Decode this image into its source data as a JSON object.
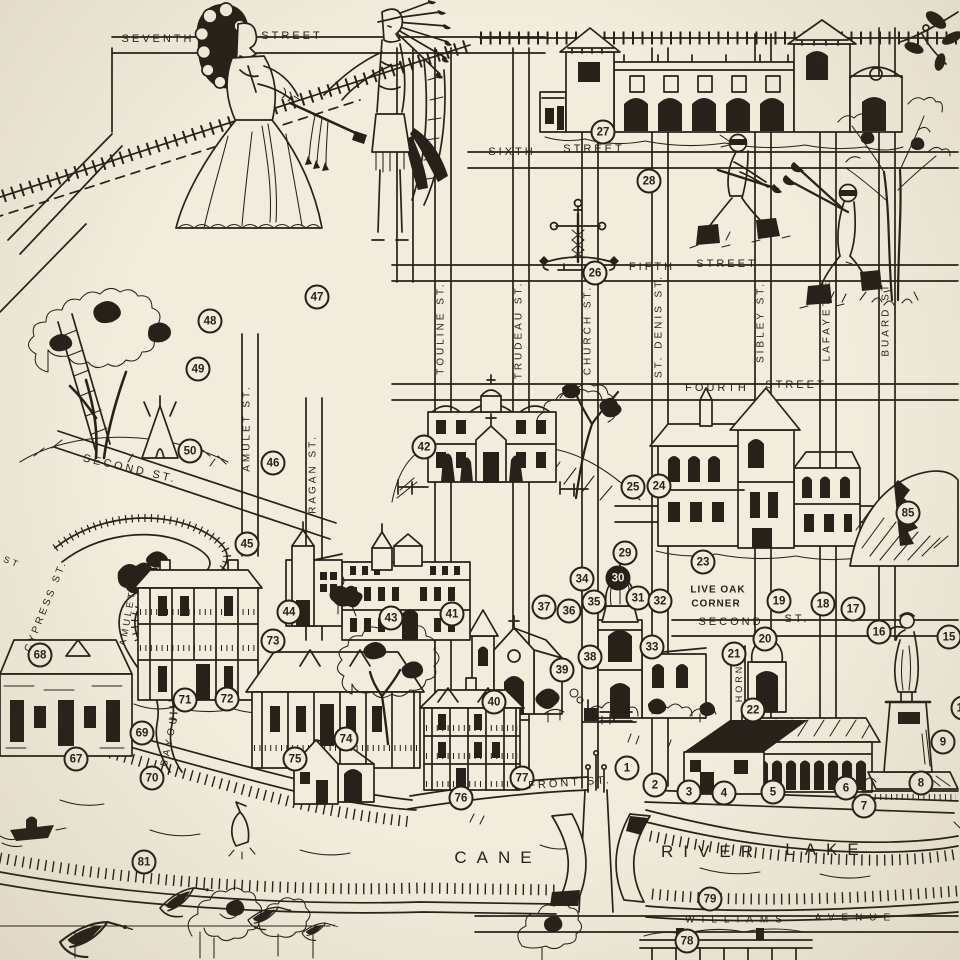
{
  "map": {
    "paper_color": "#f2ecdc",
    "ink_color": "#27211a",
    "illustrations": [
      "colonial-woman-figure",
      "indian-chief-figure",
      "peace-pipe",
      "railroad-tracks",
      "mission-revival-building",
      "raquette-players",
      "iron-cross-monument",
      "live-oak-tree",
      "ladder",
      "tepee",
      "convent-building",
      "courthouse-building",
      "rocky-hill",
      "cathedral",
      "gothic-chapel",
      "school-building",
      "small-church",
      "plantation-house",
      "stone-cottage",
      "raised-cottage",
      "victorian-house",
      "arcade-building",
      "warehouse-building",
      "st-denis-statue",
      "bridge",
      "riverfront-building",
      "motorboat",
      "jumping-fish",
      "flying-geese",
      "riverside-trees",
      "tall-tree",
      "magnolia-branch",
      "bayou-channel",
      "cane-river"
    ],
    "markers": [
      {
        "n": "1",
        "x": 627,
        "y": 768
      },
      {
        "n": "2",
        "x": 655,
        "y": 785
      },
      {
        "n": "3",
        "x": 689,
        "y": 792
      },
      {
        "n": "4",
        "x": 724,
        "y": 793
      },
      {
        "n": "5",
        "x": 773,
        "y": 792
      },
      {
        "n": "6",
        "x": 846,
        "y": 788
      },
      {
        "n": "7",
        "x": 864,
        "y": 806
      },
      {
        "n": "8",
        "x": 921,
        "y": 783
      },
      {
        "n": "9",
        "x": 943,
        "y": 742
      },
      {
        "n": "14",
        "x": 963,
        "y": 708
      },
      {
        "n": "15",
        "x": 949,
        "y": 637
      },
      {
        "n": "16",
        "x": 879,
        "y": 632
      },
      {
        "n": "17",
        "x": 853,
        "y": 609
      },
      {
        "n": "18",
        "x": 823,
        "y": 604
      },
      {
        "n": "19",
        "x": 779,
        "y": 601
      },
      {
        "n": "20",
        "x": 765,
        "y": 639
      },
      {
        "n": "21",
        "x": 734,
        "y": 654
      },
      {
        "n": "22",
        "x": 753,
        "y": 710
      },
      {
        "n": "23",
        "x": 703,
        "y": 562
      },
      {
        "n": "24",
        "x": 659,
        "y": 486
      },
      {
        "n": "25",
        "x": 633,
        "y": 487
      },
      {
        "n": "26",
        "x": 595,
        "y": 273
      },
      {
        "n": "27",
        "x": 603,
        "y": 132
      },
      {
        "n": "28",
        "x": 649,
        "y": 181
      },
      {
        "n": "29",
        "x": 625,
        "y": 553
      },
      {
        "n": "30",
        "x": 618,
        "y": 578,
        "filled": true
      },
      {
        "n": "31",
        "x": 638,
        "y": 598
      },
      {
        "n": "32",
        "x": 660,
        "y": 601
      },
      {
        "n": "33",
        "x": 652,
        "y": 647
      },
      {
        "n": "34",
        "x": 582,
        "y": 579
      },
      {
        "n": "35",
        "x": 594,
        "y": 602
      },
      {
        "n": "36",
        "x": 569,
        "y": 611
      },
      {
        "n": "37",
        "x": 544,
        "y": 607
      },
      {
        "n": "38",
        "x": 590,
        "y": 657
      },
      {
        "n": "39",
        "x": 562,
        "y": 670
      },
      {
        "n": "40",
        "x": 494,
        "y": 702
      },
      {
        "n": "41",
        "x": 452,
        "y": 614
      },
      {
        "n": "42",
        "x": 424,
        "y": 447
      },
      {
        "n": "43",
        "x": 391,
        "y": 618
      },
      {
        "n": "44",
        "x": 289,
        "y": 612
      },
      {
        "n": "45",
        "x": 247,
        "y": 544
      },
      {
        "n": "46",
        "x": 273,
        "y": 463
      },
      {
        "n": "47",
        "x": 317,
        "y": 297
      },
      {
        "n": "48",
        "x": 210,
        "y": 321
      },
      {
        "n": "49",
        "x": 198,
        "y": 369
      },
      {
        "n": "50",
        "x": 190,
        "y": 451
      },
      {
        "n": "67",
        "x": 76,
        "y": 759
      },
      {
        "n": "68",
        "x": 40,
        "y": 655
      },
      {
        "n": "69",
        "x": 142,
        "y": 733
      },
      {
        "n": "70",
        "x": 152,
        "y": 778
      },
      {
        "n": "71",
        "x": 185,
        "y": 700
      },
      {
        "n": "72",
        "x": 227,
        "y": 699
      },
      {
        "n": "73",
        "x": 273,
        "y": 641
      },
      {
        "n": "74",
        "x": 346,
        "y": 739
      },
      {
        "n": "75",
        "x": 295,
        "y": 759
      },
      {
        "n": "76",
        "x": 461,
        "y": 798
      },
      {
        "n": "77",
        "x": 522,
        "y": 778
      },
      {
        "n": "78",
        "x": 687,
        "y": 941
      },
      {
        "n": "79",
        "x": 710,
        "y": 899
      },
      {
        "n": "81",
        "x": 144,
        "y": 862
      },
      {
        "n": "85",
        "x": 908,
        "y": 513
      }
    ],
    "labels": [
      {
        "t": "SEVENTH",
        "x": 158,
        "y": 39
      },
      {
        "t": "STREET",
        "x": 292,
        "y": 36
      },
      {
        "t": "SIXTH",
        "x": 512,
        "y": 152
      },
      {
        "t": "STREET",
        "x": 594,
        "y": 149
      },
      {
        "t": "FIFTH",
        "x": 652,
        "y": 267
      },
      {
        "t": "STREET",
        "x": 727,
        "y": 264
      },
      {
        "t": "FOURTH",
        "x": 717,
        "y": 388
      },
      {
        "t": "STREET",
        "x": 796,
        "y": 385
      },
      {
        "t": "SECOND ST.",
        "x": 130,
        "y": 469,
        "r": 13
      },
      {
        "t": "SECOND",
        "x": 731,
        "y": 622
      },
      {
        "t": "ST.",
        "x": 797,
        "y": 619
      },
      {
        "t": "FRONT ST.",
        "x": 570,
        "y": 783,
        "r": -4
      },
      {
        "t": "WILLIAMS",
        "x": 737,
        "y": 920,
        "s": 10,
        "ls": 7
      },
      {
        "t": "AVENUE",
        "x": 856,
        "y": 918,
        "s": 10,
        "ls": 7
      },
      {
        "t": "TOULINE ST.",
        "x": 441,
        "y": 328,
        "r": -90,
        "s": 10
      },
      {
        "t": "TRUDEAU ST.",
        "x": 519,
        "y": 330,
        "r": -90,
        "s": 10
      },
      {
        "t": "CHURCH ST.",
        "x": 588,
        "y": 330,
        "r": -90,
        "s": 10
      },
      {
        "t": "ST. DENIS ST.",
        "x": 659,
        "y": 326,
        "r": -90,
        "s": 10
      },
      {
        "t": "SIBLEY ST.",
        "x": 761,
        "y": 322,
        "r": -90,
        "s": 10
      },
      {
        "t": "LAFAYETTE",
        "x": 827,
        "y": 320,
        "r": -90,
        "s": 10
      },
      {
        "t": "BUARD ST.",
        "x": 886,
        "y": 317,
        "r": -90,
        "s": 10
      },
      {
        "t": "AMULET ST.",
        "x": 247,
        "y": 428,
        "r": -90,
        "s": 10
      },
      {
        "t": "RAGAN ST.",
        "x": 313,
        "y": 474,
        "r": -90,
        "s": 10
      },
      {
        "t": "CYPRESS ST.",
        "x": 46,
        "y": 606,
        "r": -68,
        "s": 10
      },
      {
        "t": "AMULET",
        "x": 128,
        "y": 618,
        "r": -80,
        "s": 9.5
      },
      {
        "t": "BAYOU",
        "x": 170,
        "y": 740,
        "r": -78,
        "s": 10,
        "ls": 4
      },
      {
        "t": "HORN",
        "x": 739,
        "y": 683,
        "r": -90,
        "s": 9
      },
      {
        "t": "ST",
        "x": 12,
        "y": 562,
        "r": 22,
        "s": 9
      },
      {
        "t": "LIVE OAK",
        "x": 718,
        "y": 590,
        "k": "place"
      },
      {
        "t": "CORNER",
        "x": 716,
        "y": 604,
        "k": "place"
      },
      {
        "t": "CANE",
        "x": 498,
        "y": 858,
        "k": "water"
      },
      {
        "t": "RIVER",
        "x": 712,
        "y": 852,
        "k": "water"
      },
      {
        "t": "LAKE",
        "x": 827,
        "y": 850,
        "k": "water"
      }
    ]
  }
}
